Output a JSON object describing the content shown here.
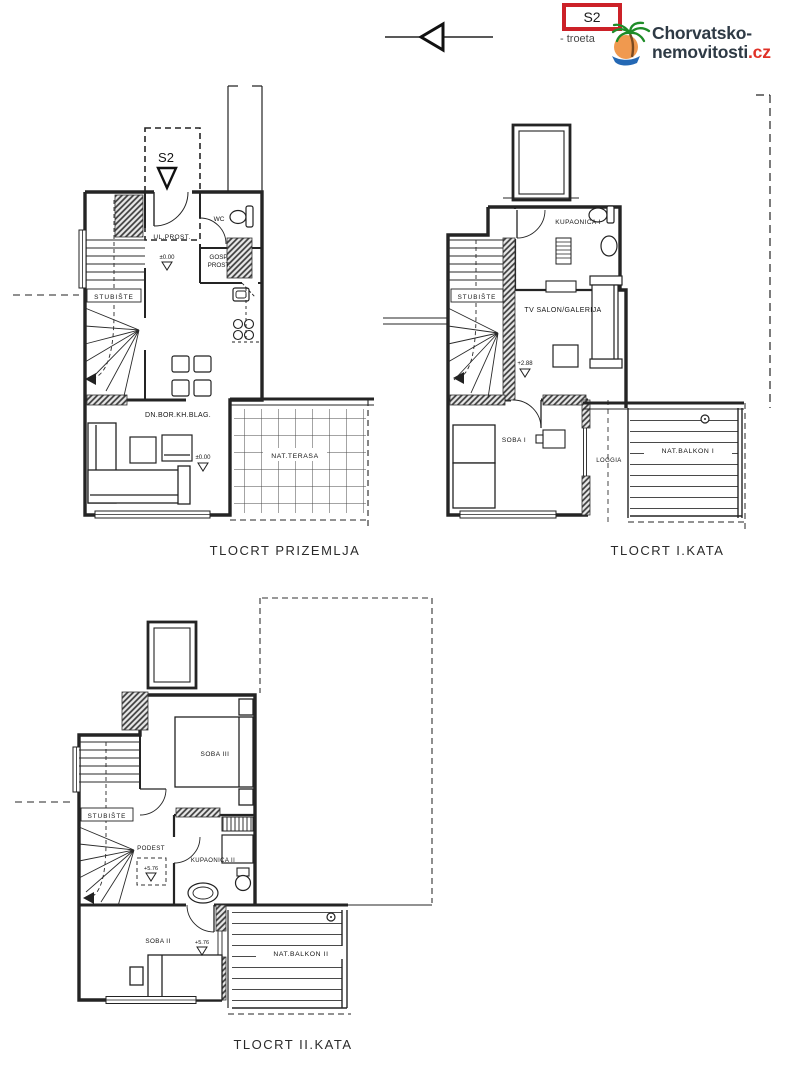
{
  "header": {
    "badge": {
      "label": "S2",
      "note": "- troeta"
    },
    "logo": {
      "line1": "Chorvatsko-",
      "line2": "nemovitosti",
      "tld": ".cz"
    }
  },
  "colors": {
    "badge_red": "#cc2128",
    "logo_text": "#2e3a45",
    "logo_tld_red": "#e03127",
    "palm_green": "#1e8c28",
    "sun_orange": "#f0994f",
    "wave_blue": "#2468b4",
    "line_ink": "#222222"
  },
  "plans": {
    "ground": {
      "caption": "TLOCRT PRIZEMLJA",
      "labels": {
        "unit": "S2",
        "entrance": "UL.PROST.",
        "entrance_level": "±0.00",
        "wc": "WC",
        "utility1": "GOSP.",
        "utility2": "PROST.",
        "stairs": "STUBIŠTE",
        "living": "DN.BOR.KH.BLAG.",
        "living_level": "±0.00",
        "terrace": "NAT.TERASA"
      }
    },
    "first": {
      "caption": "TLOCRT I.KATA",
      "labels": {
        "bathroom": "KUPAONICA I",
        "stairs": "STUBIŠTE",
        "salon": "TV SALON/GALERIJA",
        "level": "+2.88",
        "room": "SOBA I",
        "loggia": "LOGGIA",
        "balcony": "NAT.BALKON I"
      }
    },
    "second": {
      "caption": "TLOCRT II.KATA",
      "labels": {
        "room_top": "SOBA III",
        "stairs": "STUBIŠTE",
        "landing": "PODEST",
        "landing_level": "+5.76",
        "bathroom": "KUPAONICA II",
        "room_bottom": "SOBA II",
        "room_level": "+5.76",
        "balcony": "NAT.BALKON II"
      }
    }
  }
}
